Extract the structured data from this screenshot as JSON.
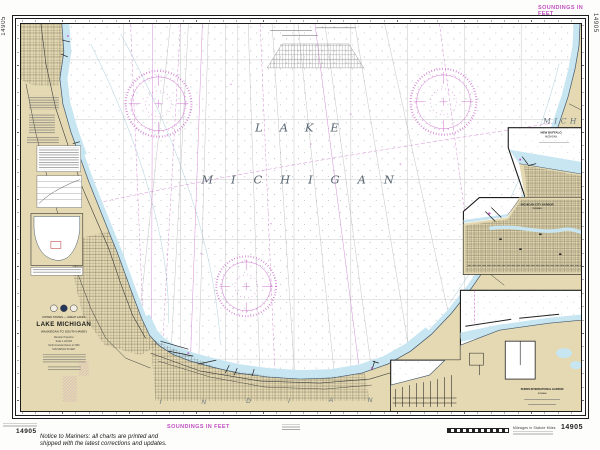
{
  "chart": {
    "number": "14905",
    "soundings_note": "SOUNDINGS IN FEET",
    "notice": {
      "line1": "Notice to Mariners: all charts are printed and",
      "line2": "shipped with the latest corrections and updates."
    },
    "scale_bar_caption": "Mileages in Statute Miles"
  },
  "lake": {
    "word1": "LAKE",
    "word2": "MICHIGAN"
  },
  "states": {
    "michigan_abbrev": "MICH",
    "indiana_letters": [
      "I",
      "N",
      "D",
      "I",
      "A",
      "N"
    ]
  },
  "title_block": {
    "region": "UNITED STATES — GREAT LAKES",
    "title": "LAKE MICHIGAN",
    "subtitle": "WAUKEGAN TO SOUTH HAVEN",
    "projection": "Mercator Projection",
    "scale": "Scale 1:120,000",
    "datum": "North American Datum of 1983",
    "units": "SOUNDINGS IN FEET"
  },
  "insets": {
    "new_buffalo": {
      "title_line1": "NEW BUFFALO",
      "title_line2": "MICHIGAN"
    },
    "michigan_city": {
      "title_line1": "MICHIGAN CITY HARBOR",
      "title_line2": "INDIANA"
    },
    "burns_harbor": {
      "title_line1": "BURNS INTERNATIONAL HARBOR",
      "title_line2": "INDIANA"
    }
  },
  "colors": {
    "magenta": "#c050c0",
    "land_tan": "#e4d9b2",
    "shallow_blue": "#c7e6f2"
  }
}
